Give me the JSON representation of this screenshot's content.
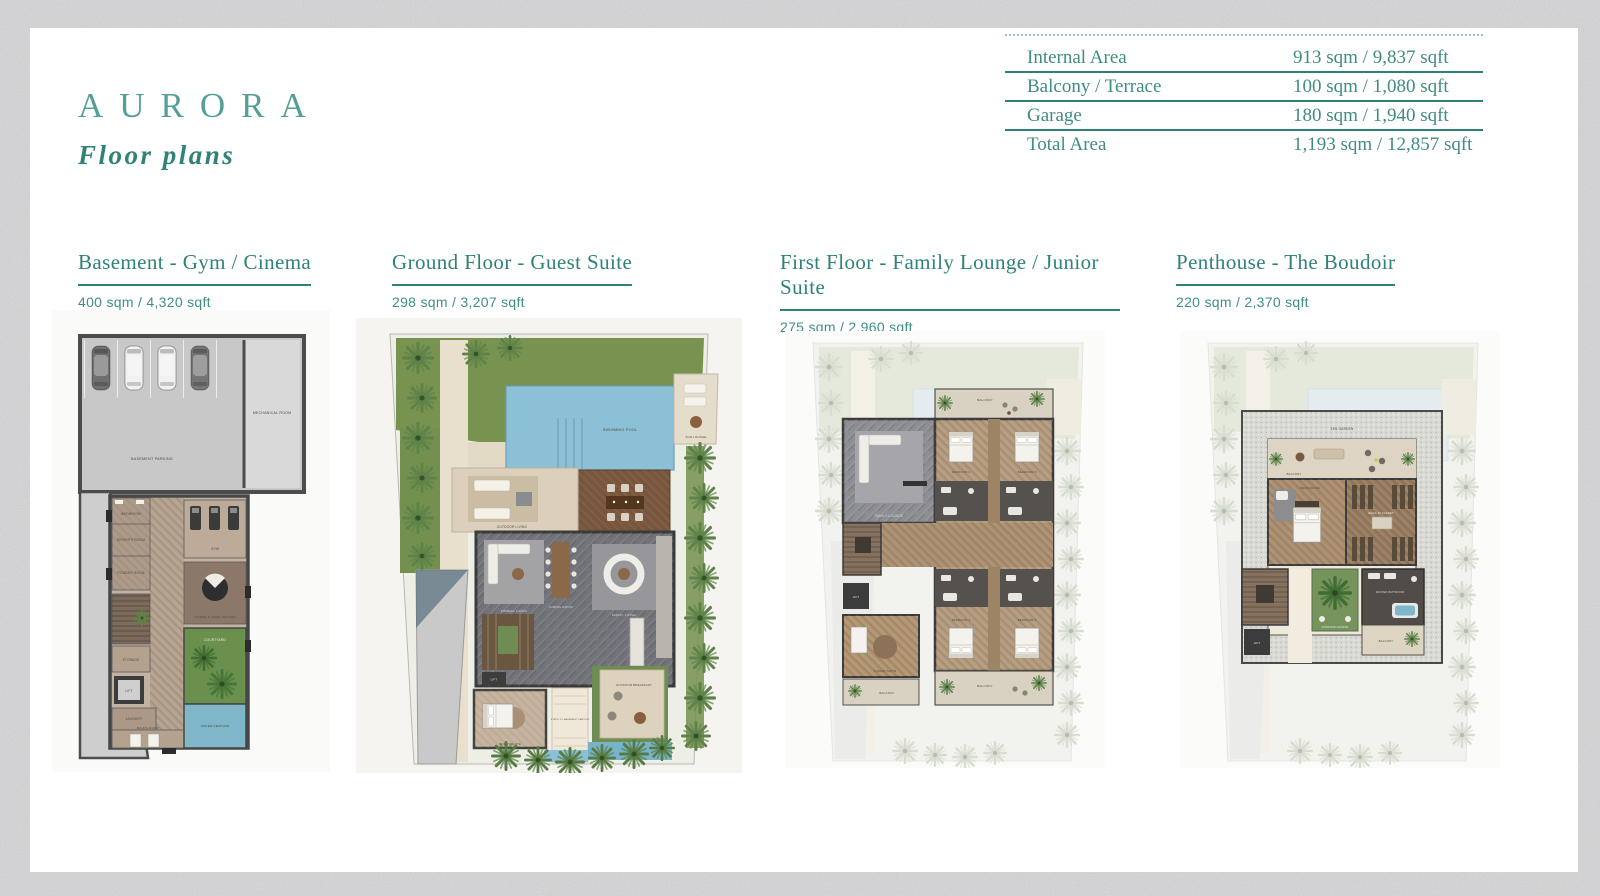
{
  "brand": {
    "name": "AURORA",
    "tagline": "Floor plans"
  },
  "colors": {
    "accent_teal": "#2f8277",
    "light_teal": "#55a096",
    "rule_teal": "#2f7f76"
  },
  "area_table": {
    "rows": [
      {
        "label": "Internal Area",
        "value": "913 sqm / 9,837 sqft"
      },
      {
        "label": "Balcony / Terrace",
        "value": "100 sqm / 1,080 sqft"
      },
      {
        "label": "Garage",
        "value": "180 sqm / 1,940 sqft"
      },
      {
        "label": "Total Area",
        "value": "1,193 sqm / 12,857 sqft"
      }
    ]
  },
  "sections": [
    {
      "title": "Basement - Gym / Cinema",
      "area": "400 sqm / 4,320 sqft",
      "rooms": {
        "parking": "BASEMENT PARKING",
        "mechanical": "MECHANICAL ROOM",
        "bathroom": "BATHROOM",
        "drivers": "DRIVER'S ROOM",
        "powder": "POWDER ROOM",
        "gym": "GYM",
        "cinema": "CINEMA & HOME THEATER",
        "storage": "STORAGE",
        "lift": "LIFT",
        "laundry": "LAUNDRY",
        "maids": "MAID'S ROOM",
        "courtyard": "COURTYARD",
        "water": "WATER FEATURE"
      }
    },
    {
      "title": "Ground Floor - Guest Suite",
      "area": "298 sqm / 3,207 sqft",
      "rooms": {
        "pool": "SWIMMING POOL",
        "sun": "SUN LOUNGE",
        "outdoor_living": "OUTDOOR LIVING",
        "outdoor_dining": "OUTDOOR DINING",
        "formal_living": "FORMAL LIVING",
        "dining": "DINING ROOM",
        "family_living": "FAMILY LIVING",
        "kitchen": "SHOW KITCHEN",
        "lift": "LIFT",
        "guest": "GUEST SUITE",
        "breakfast": "OUTDOOR BREAKFAST",
        "steps": "STEPS TO BASEMENT SERVICE"
      }
    },
    {
      "title": "First Floor - Family Lounge / Junior Suite",
      "area": "275 sqm / 2,960 sqft",
      "rooms": {
        "lounge": "FAMILY LOUNGE",
        "bed2": "BEDROOM 2",
        "bed3": "BEDROOM 3",
        "bed4": "BEDROOM 4",
        "bed5": "BEDROOM 5",
        "junior": "JUNIOR SUITE",
        "lift": "LIFT",
        "balcony_top": "BALCONY",
        "balcony_bottom": "BALCONY",
        "balcony_left": "BALCONY"
      }
    },
    {
      "title": "Penthouse - The Boudoir",
      "area": "220 sqm / 2,370 sqft",
      "rooms": {
        "zen": "ZEN GARDEN",
        "balcony_top": "BALCONY",
        "penthouse": "PENTHOUSE",
        "closet": "WALK-IN CLOSET",
        "outdoor_lounge": "OUTDOOR LOUNGE",
        "master_bath": "MASTER BATHROOM",
        "lift": "LIFT",
        "balcony_bottom": "BALCONY"
      }
    }
  ]
}
